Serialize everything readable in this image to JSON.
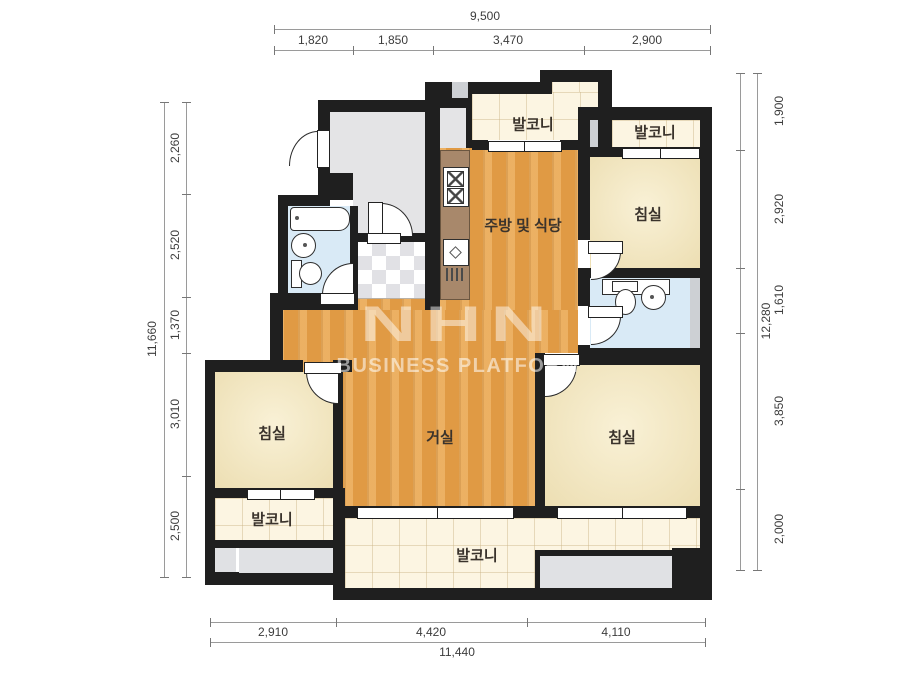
{
  "title": "apartment-floor-plan",
  "rooms": {
    "balcony_top_center": "발코니",
    "balcony_top_right": "발코니",
    "bedroom_top_right": "침실",
    "kitchen_dining": "주방 및 식당",
    "bedroom_left": "침실",
    "living_room": "거실",
    "bedroom_right": "침실",
    "balcony_left": "발코니",
    "balcony_bottom": "발코니"
  },
  "dimensions": {
    "top": {
      "total": "9,500",
      "segments": [
        "1,820",
        "1,850",
        "3,470",
        "2,900"
      ]
    },
    "left": {
      "total": "11,660",
      "segments": [
        "2,260",
        "2,520",
        "1,370",
        "3,010",
        "2,500"
      ]
    },
    "right": {
      "total": "12,280",
      "segments": [
        "1,900",
        "2,920",
        "1,610",
        "3,850",
        "2,000"
      ]
    },
    "bottom": {
      "total": "11,440",
      "segments": [
        "2,910",
        "4,420",
        "4,110"
      ]
    }
  },
  "watermark": {
    "line1": "NHN",
    "line2": "BUSINESS PLATFORM"
  },
  "colors": {
    "wall": "#1f1f1f",
    "wood_floor": "#e7a049",
    "bedroom_floor": "#f3e6c2",
    "balcony_floor": "#fcf5e2",
    "bathroom_floor": "#d9eaf6",
    "entry_floor": "#e4e4e6",
    "counter": "#a8886b"
  }
}
